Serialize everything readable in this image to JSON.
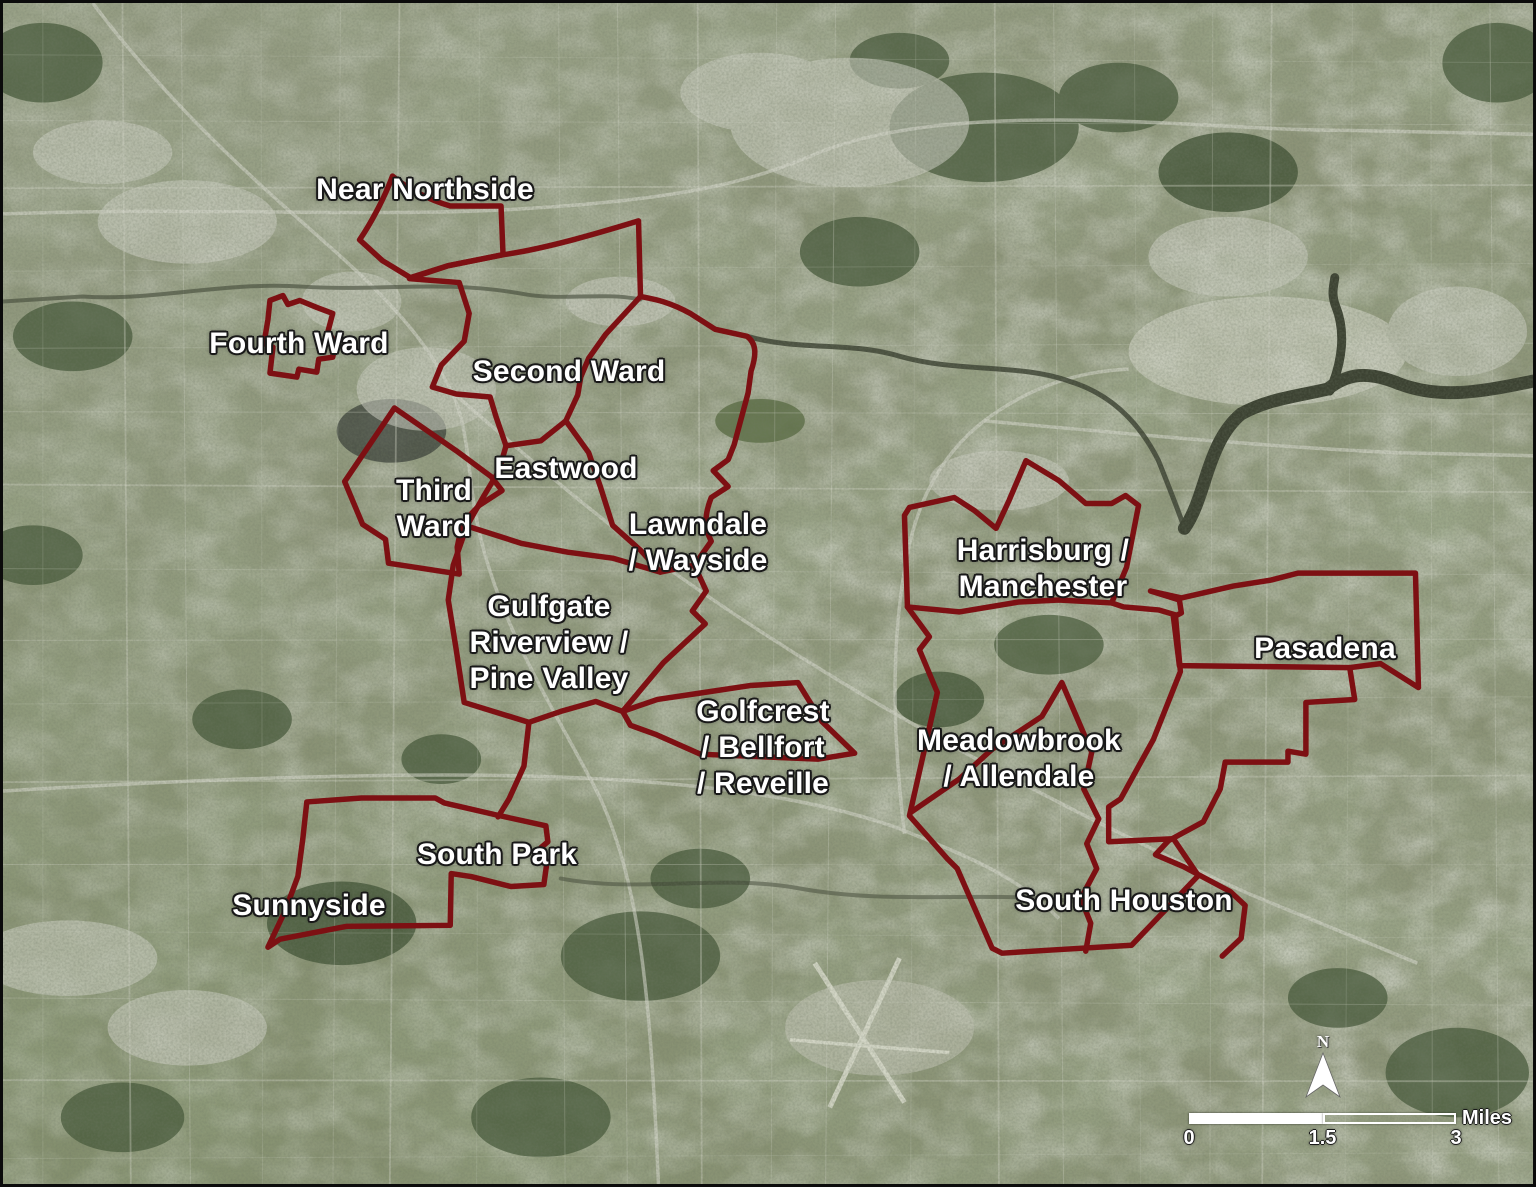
{
  "map": {
    "region_title": "Houston neighborhoods satellite map",
    "neighborhood_labels": [
      {
        "id": "near-northside",
        "text": "Near Northside",
        "x": 422,
        "y": 187
      },
      {
        "id": "fourth-ward",
        "text": "Fourth Ward",
        "x": 296,
        "y": 341
      },
      {
        "id": "second-ward",
        "text": "Second Ward",
        "x": 566,
        "y": 369
      },
      {
        "id": "eastwood",
        "text": "Eastwood",
        "x": 563,
        "y": 466
      },
      {
        "id": "third-ward",
        "text": "Third\nWard",
        "x": 431,
        "y": 506
      },
      {
        "id": "lawndale-wayside",
        "text": "Lawndale\n/ Wayside",
        "x": 695,
        "y": 540
      },
      {
        "id": "gulfgate-riverview-pine-valley",
        "text": "Gulfgate\nRiverview /\nPine Valley",
        "x": 546,
        "y": 640
      },
      {
        "id": "harrisburg-manchester",
        "text": "Harrisburg /\nManchester",
        "x": 1040,
        "y": 566
      },
      {
        "id": "pasadena",
        "text": "Pasadena",
        "x": 1322,
        "y": 646
      },
      {
        "id": "golfcrest-bellfort-reveille",
        "text": "Golfcrest\n/ Bellfort\n/ Reveille",
        "x": 760,
        "y": 745
      },
      {
        "id": "meadowbrook-allendale",
        "text": "Meadowbrook\n/ Allendale",
        "x": 1016,
        "y": 756
      },
      {
        "id": "south-park",
        "text": "South Park",
        "x": 494,
        "y": 852
      },
      {
        "id": "sunnyside",
        "text": "Sunnyside",
        "x": 306,
        "y": 903
      },
      {
        "id": "south-houston",
        "text": "South Houston",
        "x": 1121,
        "y": 898
      }
    ],
    "north_arrow": {
      "letter": "N"
    },
    "scale_bar": {
      "ticks": [
        "0",
        "1.5",
        "3"
      ],
      "unit": "Miles"
    },
    "colors": {
      "boundary": "#7d1013",
      "label_text": "#ffffff",
      "label_halo": "#191919",
      "water": "#3c4232",
      "land": "#8c9377"
    }
  }
}
